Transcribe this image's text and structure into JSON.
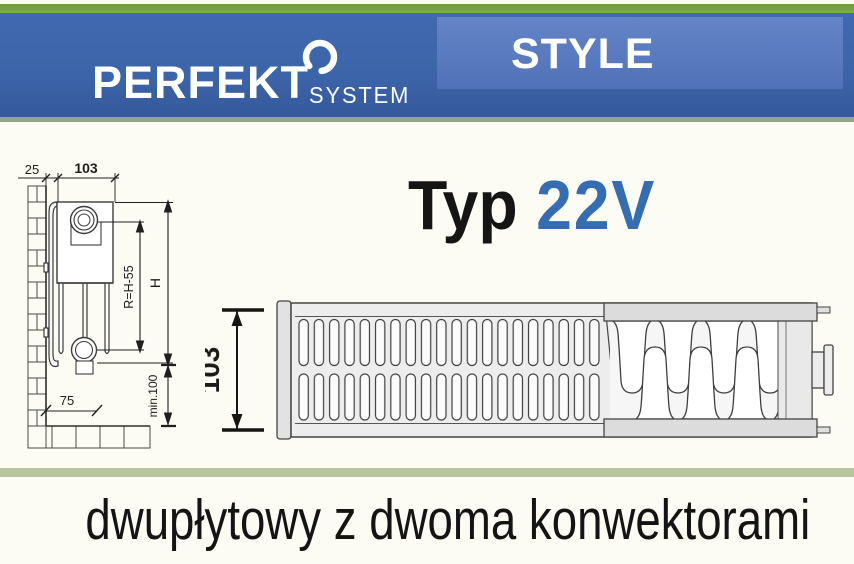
{
  "brand": {
    "name": "PERFEKT",
    "sub": "SYSTEM",
    "series": "STYLE"
  },
  "product": {
    "type_label": "Typ",
    "type_code": "22V"
  },
  "caption": "dwupłytowy z dwoma konwektorami",
  "side_view": {
    "dim_wall_offset": "25",
    "dim_depth": "103",
    "dim_radius": "R=H-55",
    "dim_height": "H",
    "dim_min_clearance": "min.100",
    "dim_floor_offset": "75"
  },
  "top_view": {
    "dim_depth": "103"
  },
  "colors": {
    "header_blue": "#3c64a8",
    "panel_blue": "#5b7cc0",
    "accent_green": "#79a83e",
    "divider_sage": "#b8c49e",
    "code_blue": "#346db2"
  }
}
